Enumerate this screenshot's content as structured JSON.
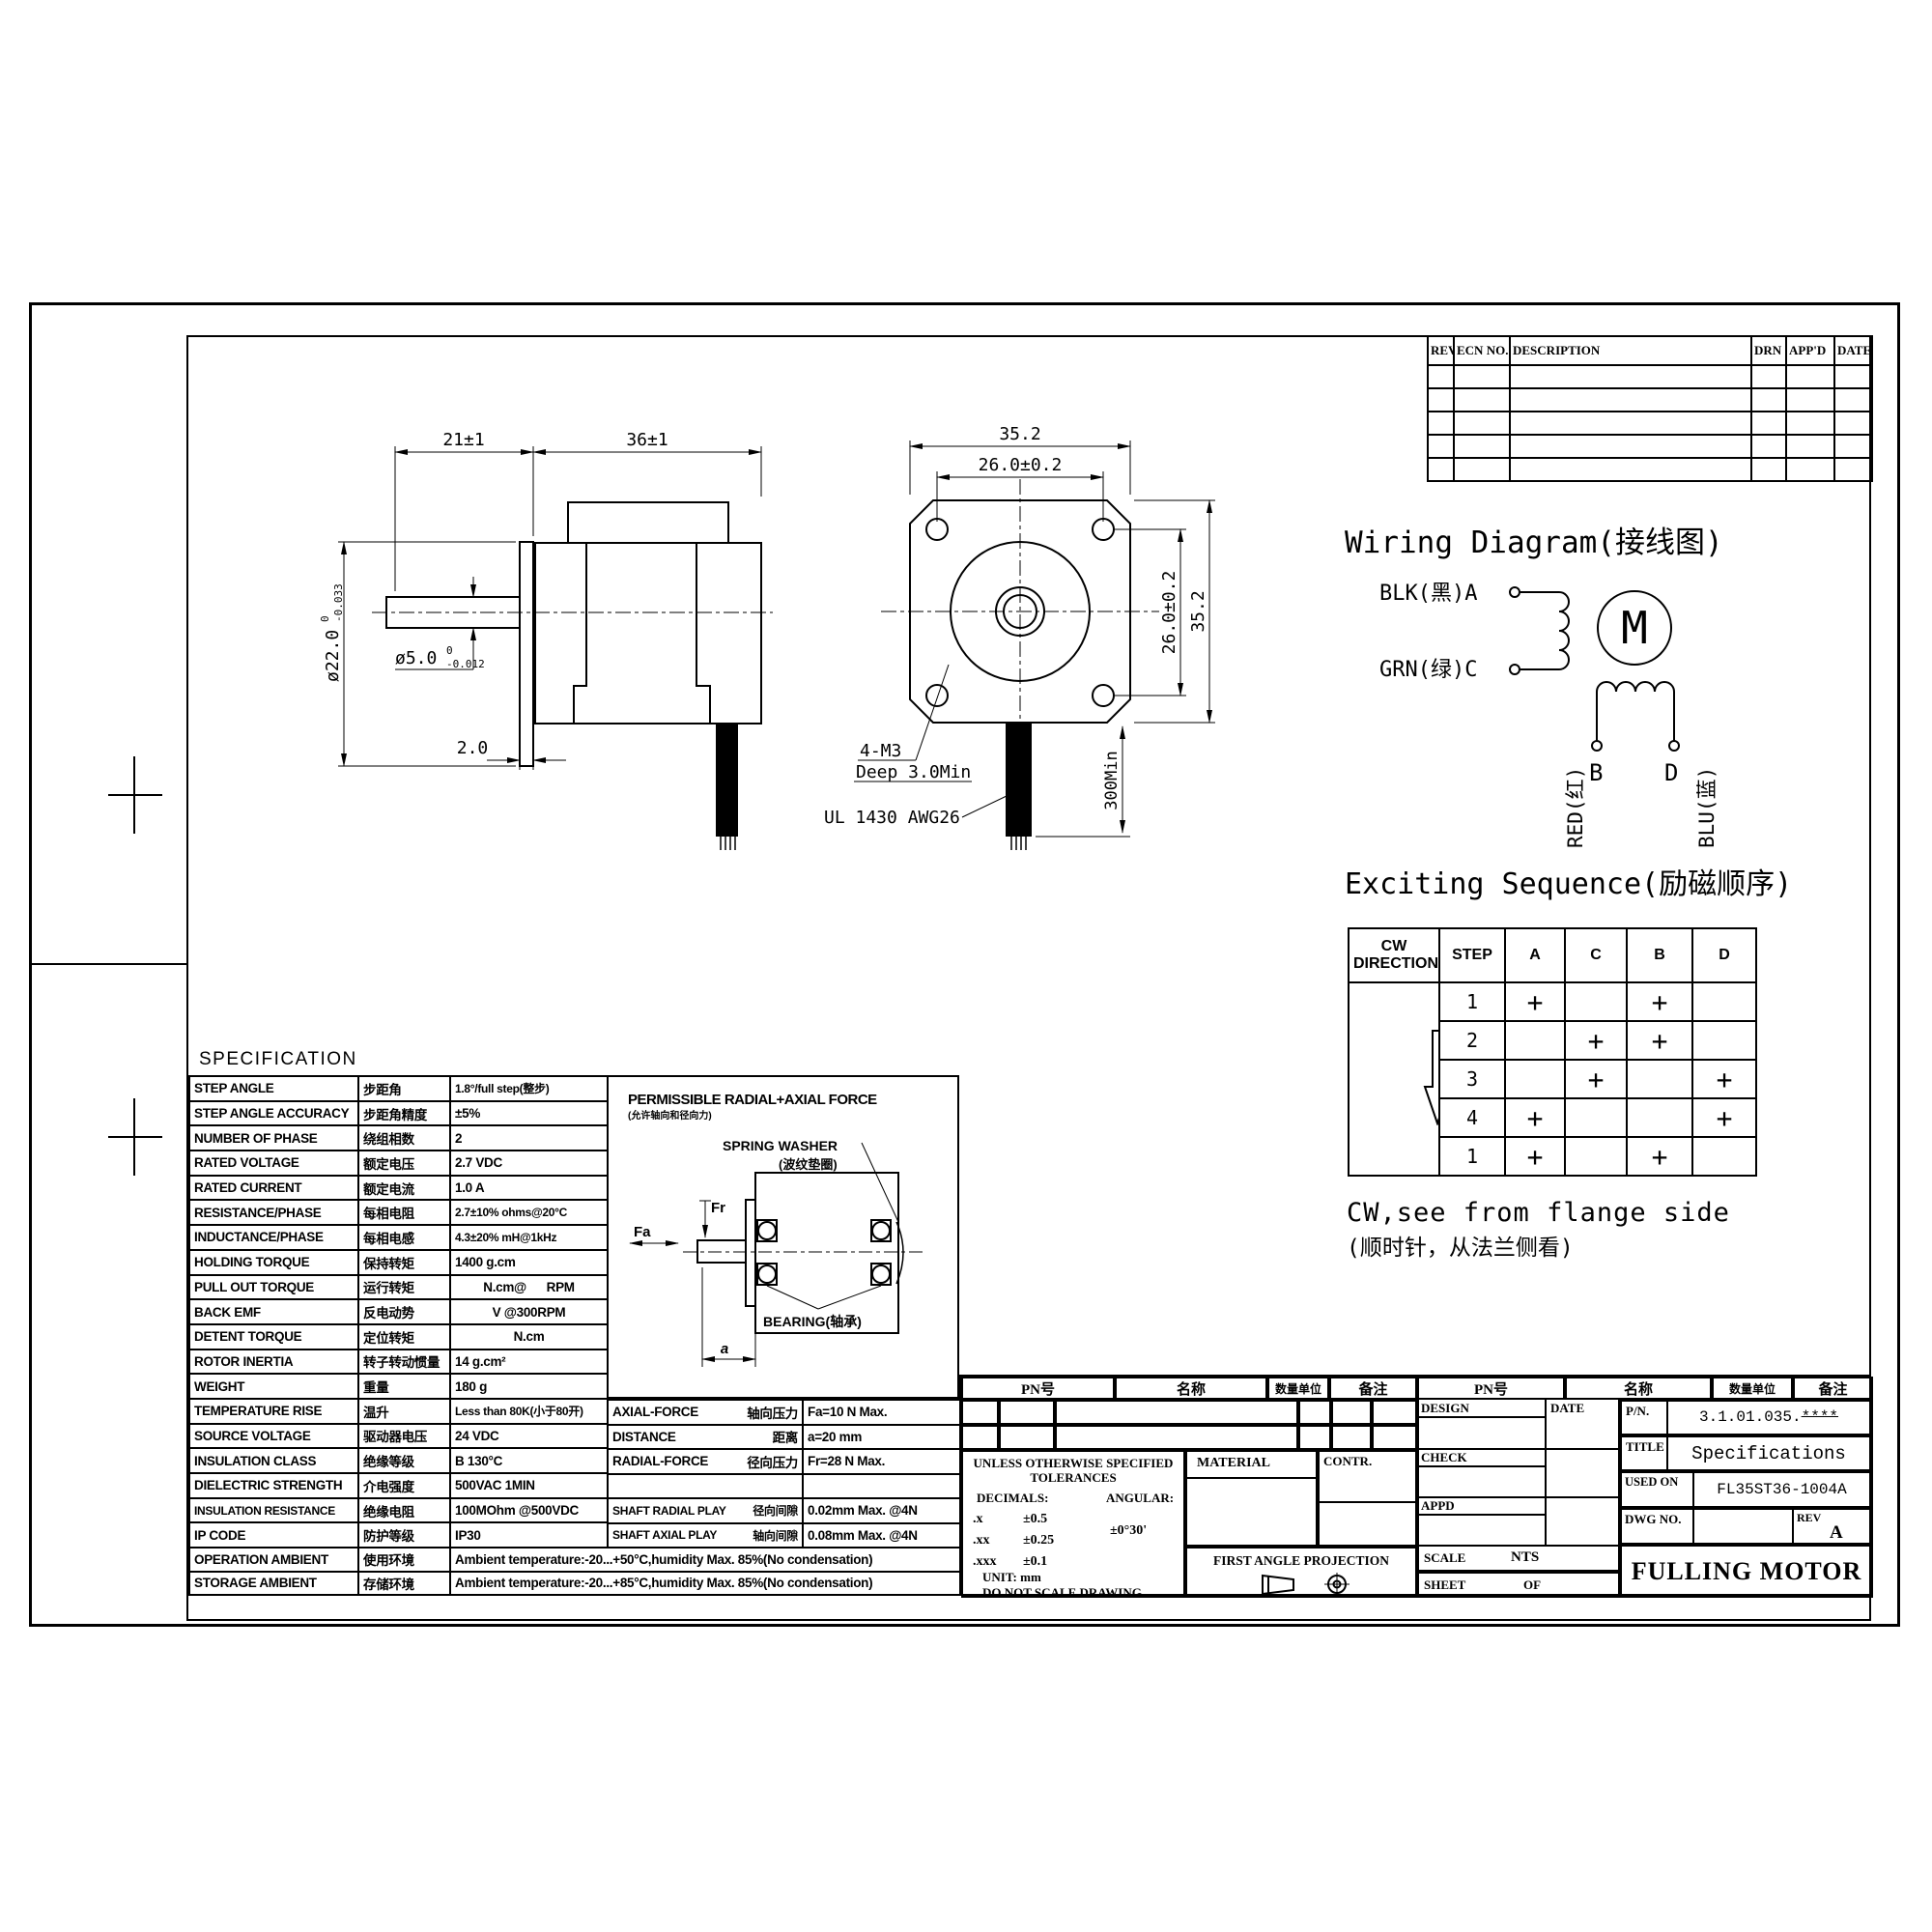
{
  "colors": {
    "ink": "#000000",
    "paper": "#ffffff"
  },
  "revision_table": {
    "headers": [
      "REV",
      "ECN NO.",
      "DESCRIPTION",
      "DRN",
      "APP'D",
      "DATE"
    ]
  },
  "side_view": {
    "dim_shaft_length": "21±1",
    "dim_body_length": "36±1",
    "dim_boss_dia": "ø22.0",
    "dim_boss_tol_upper": "0",
    "dim_boss_tol_lower": "-0.033",
    "dim_shaft_dia": "ø5.0",
    "dim_shaft_tol_upper": "0",
    "dim_shaft_tol_lower": "-0.012",
    "dim_boss_thickness": "2.0"
  },
  "front_view": {
    "dim_width": "35.2",
    "dim_hole_pitch_h": "26.0±0.2",
    "dim_hole_pitch_v": "26.0±0.2",
    "dim_height": "35.2",
    "note_holes_line1": "4-M3",
    "note_holes_line2": "Deep 3.0Min",
    "note_cable": "UL 1430 AWG26",
    "dim_cable_length": "300Min"
  },
  "wiring": {
    "title": "Wiring Diagram(接线图)",
    "lead_a": "BLK(黑)A",
    "lead_c": "GRN(绿)C",
    "motor_symbol": "M",
    "terminal_b": "B",
    "terminal_d": "D",
    "lead_b": "RED(红)",
    "lead_d": "BLU(蓝)",
    "sequence_title": "Exciting Sequence(励磁顺序)",
    "note_en": "CW,see from flange side",
    "note_cn": "(顺时针，从法兰侧看)"
  },
  "sequence_table": {
    "direction_header": "CW DIRECTION",
    "headers": [
      "STEP",
      "A",
      "C",
      "B",
      "D"
    ],
    "rows": [
      {
        "step": "1",
        "a": "+",
        "c": "",
        "b": "+",
        "d": ""
      },
      {
        "step": "2",
        "a": "",
        "c": "+",
        "b": "+",
        "d": ""
      },
      {
        "step": "3",
        "a": "",
        "c": "+",
        "b": "",
        "d": "+"
      },
      {
        "step": "4",
        "a": "+",
        "c": "",
        "b": "",
        "d": "+"
      },
      {
        "step": "1",
        "a": "+",
        "c": "",
        "b": "+",
        "d": ""
      }
    ]
  },
  "spec": {
    "title": "SPECIFICATION",
    "rows": [
      {
        "en": "STEP ANGLE",
        "cn": "步距角",
        "value": "1.8°/full step(整步)"
      },
      {
        "en": "STEP ANGLE ACCURACY",
        "cn": "步距角精度",
        "value": "±5%"
      },
      {
        "en": "NUMBER OF PHASE",
        "cn": "绕组相数",
        "value": "2"
      },
      {
        "en": "RATED VOLTAGE",
        "cn": "额定电压",
        "value": "2.7 VDC"
      },
      {
        "en": "RATED CURRENT",
        "cn": "额定电流",
        "value": "1.0 A"
      },
      {
        "en": "RESISTANCE/PHASE",
        "cn": "每相电阻",
        "value": "2.7±10% ohms@20°C"
      },
      {
        "en": "INDUCTANCE/PHASE",
        "cn": "每相电感",
        "value": "4.3±20% mH@1kHz"
      },
      {
        "en": "HOLDING TORQUE",
        "cn": "保持转矩",
        "value": "1400 g.cm"
      },
      {
        "en": "PULL OUT TORQUE",
        "cn": "运行转矩",
        "value": "N.cm@      RPM"
      },
      {
        "en": "BACK EMF",
        "cn": "反电动势",
        "value": "V @300RPM"
      },
      {
        "en": "DETENT TORQUE",
        "cn": "定位转矩",
        "value": "N.cm"
      },
      {
        "en": "ROTOR INERTIA",
        "cn": "转子转动惯量",
        "value": "14 g.cm²"
      },
      {
        "en": "WEIGHT",
        "cn": "重量",
        "value": "180 g"
      },
      {
        "en": "TEMPERATURE RISE",
        "cn": "温升",
        "value": "Less than 80K(小于80开)"
      },
      {
        "en": "SOURCE VOLTAGE",
        "cn": "驱动器电压",
        "value": "24 VDC"
      },
      {
        "en": "INSULATION CLASS",
        "cn": "绝缘等级",
        "value": "B 130°C"
      },
      {
        "en": "DIELECTRIC STRENGTH",
        "cn": "介电强度",
        "value": "500VAC 1MIN"
      },
      {
        "en": "INSULATION RESISTANCE",
        "cn": "绝缘电阻",
        "value": "100MOhm @500VDC"
      },
      {
        "en": "IP CODE",
        "cn": "防护等级",
        "value": "IP30"
      }
    ],
    "wide_rows": [
      {
        "en": "OPERATION AMBIENT",
        "cn": "使用环境",
        "value": "Ambient temperature:-20...+50°C,humidity Max. 85%(No condensation)"
      },
      {
        "en": "STORAGE AMBIENT",
        "cn": "存储环境",
        "value": "Ambient temperature:-20...+85°C,humidity Max. 85%(No condensation)"
      }
    ],
    "force_rows": [
      {
        "en": "AXIAL-FORCE",
        "cn": "轴向压力",
        "value": "Fa=10 N Max."
      },
      {
        "en": "DISTANCE",
        "cn": "距离",
        "value": "a=20 mm"
      },
      {
        "en": "RADIAL-FORCE",
        "cn": "径向压力",
        "value": "Fr=28 N Max."
      },
      {
        "en": "",
        "cn": "",
        "value": ""
      },
      {
        "en": "SHAFT RADIAL PLAY",
        "cn": "径向间隙",
        "value": "0.02mm Max. @4N"
      },
      {
        "en": "SHAFT AXIAL PLAY",
        "cn": "轴向间隙",
        "value": "0.08mm Max. @4N"
      }
    ]
  },
  "force_diagram": {
    "title": "PERMISSIBLE RADIAL+AXIAL FORCE",
    "title_cn": "(允许轴向和径向力)",
    "spring_washer": "SPRING WASHER",
    "spring_washer_cn": "(波纹垫圈)",
    "bearing": "BEARING(轴承)",
    "fa": "Fa",
    "fr": "Fr",
    "a": "a"
  },
  "title_block": {
    "pn_col": "PN号",
    "name_col": "名称",
    "qty_col": "数量单位",
    "remark_col": "备注",
    "design": "DESIGN",
    "date": "DATE",
    "check": "CHECK",
    "appd": "APPD",
    "material": "MATERIAL",
    "contr": "CONTR.",
    "tol_line1": "UNLESS OTHERWISE SPECIFIED",
    "tol_line2": "TOLERANCES",
    "decimals": "DECIMALS:",
    "angular": "ANGULAR:",
    "tol_x": ".x",
    "tol_x_v": "±0.5",
    "tol_xx": ".xx",
    "tol_xx_v": "±0.25",
    "tol_xxx": ".xxx",
    "tol_xxx_v": "±0.1",
    "angular_v": "±0°30'",
    "unit": "UNIT: mm",
    "no_scale": "DO NOT SCALE DRAWING",
    "projection": "FIRST ANGLE PROJECTION",
    "pn_label": "P/N.",
    "pn_value": "3.1.01.035.",
    "pn_stars": "****",
    "title_label": "TITLE",
    "title_value": "Specifications",
    "used_on_label": "USED ON",
    "used_on_value": "FL35ST36-1004A",
    "dwg_label": "DWG NO.",
    "rev_label": "REV",
    "rev_value": "A",
    "scale_label": "SCALE",
    "scale_value": "NTS",
    "sheet_label": "SHEET",
    "sheet_of": "OF",
    "company": "FULLING MOTOR"
  }
}
